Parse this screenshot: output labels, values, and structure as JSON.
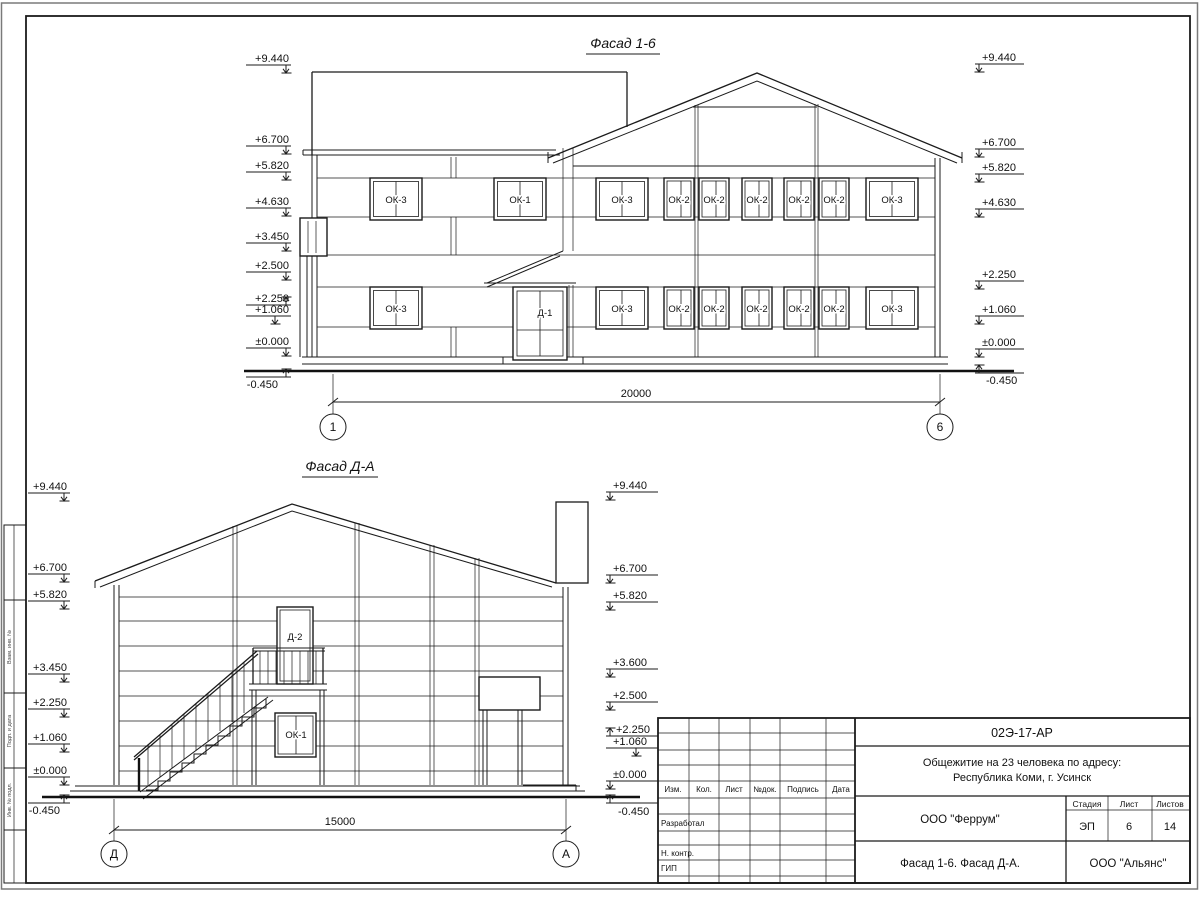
{
  "f16": {
    "title": "Фасад 1-6",
    "marks_left": [
      "+9.440",
      "+6.700",
      "+5.820",
      "+4.630",
      "+3.450",
      "+2.500",
      "+2.250",
      "+1.060",
      "±0.000",
      "-0.450"
    ],
    "marks_right": [
      "+9.440",
      "+6.700",
      "+5.820",
      "+4.630",
      "+2.250",
      "+1.060",
      "±0.000",
      "-0.450"
    ],
    "windows_upper": [
      "ОК-3",
      "ОК-1",
      "ОК-3",
      "ОК-2",
      "ОК-2",
      "ОК-2",
      "ОК-2",
      "ОК-2",
      "ОК-3"
    ],
    "windows_lower": [
      "ОК-3",
      "ОК-3",
      "ОК-2",
      "ОК-2",
      "ОК-2",
      "ОК-2",
      "ОК-2",
      "ОК-3"
    ],
    "door": "Д-1",
    "dim": "20000",
    "axis_left": "1",
    "axis_right": "6"
  },
  "fda": {
    "title": "Фасад Д-А",
    "marks_left": [
      "+9.440",
      "+6.700",
      "+5.820",
      "+3.450",
      "+2.250",
      "+1.060",
      "±0.000",
      "-0.450"
    ],
    "marks_right": [
      "+9.440",
      "+6.700",
      "+5.820",
      "+3.600",
      "+2.500",
      "+2.250",
      "+1.060",
      "±0.000",
      "-0.450"
    ],
    "door": "Д-2",
    "window": "ОК-1",
    "dim": "15000",
    "axis_left": "Д",
    "axis_right": "А"
  },
  "title_block": {
    "doc_number": "02Э-17-АР",
    "object_line1": "Общежитие на 23 человека по адресу:",
    "object_line2": "Республика Коми, г. Усинск",
    "col_izm": "Изм.",
    "col_kol": "Кол.",
    "col_list": "Лист",
    "col_ndok": "№док.",
    "col_podpis": "Подпись",
    "col_data": "Дата",
    "row_razrabotal": "Разработал",
    "row_nkontr": "Н. контр.",
    "row_gip": "ГИП",
    "designer_org": "ООО \"Феррум\"",
    "stage_label": "Стадия",
    "sheet_label": "Лист",
    "sheets_label": "Листов",
    "stage": "ЭП",
    "sheet": "6",
    "sheets": "14",
    "sheet_title": "Фасад 1-6. Фасад Д-А.",
    "client_org": "ООО \"Альянс\""
  },
  "frame": {
    "stamp1": "Взам. инв. №",
    "stamp2": "Подп. и дата",
    "stamp3": "Инв. № подл."
  }
}
